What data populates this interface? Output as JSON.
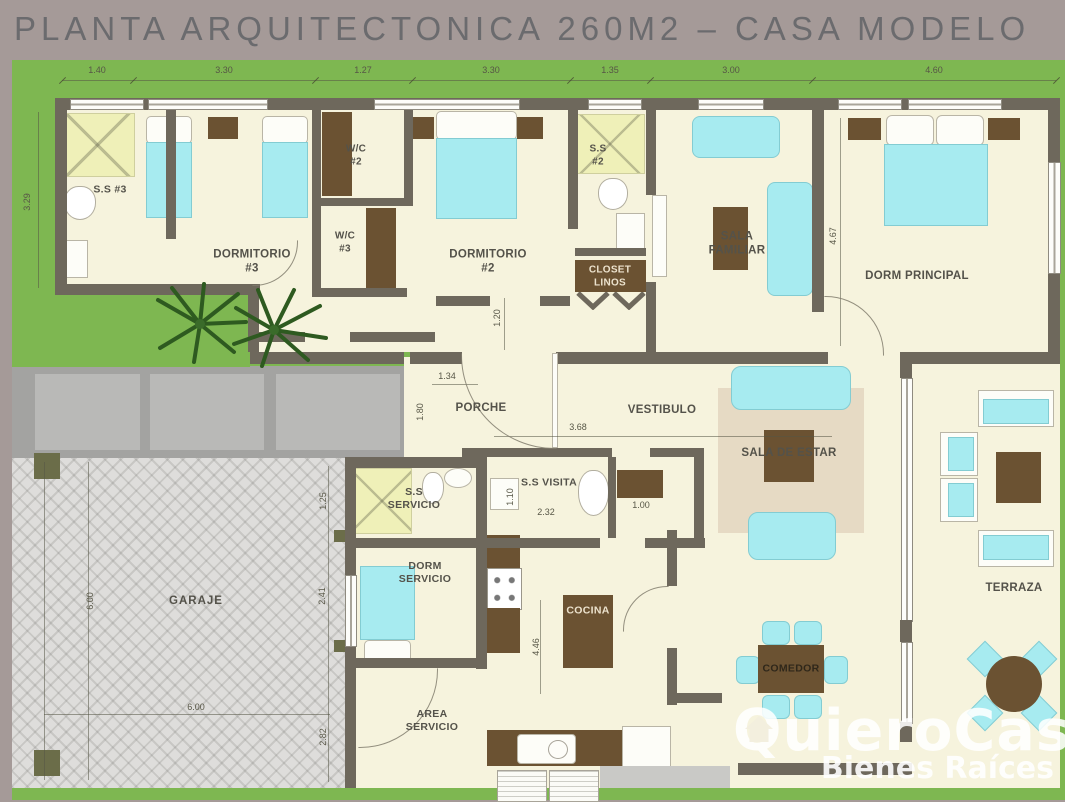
{
  "title": "PLANTA ARQUITECTONICA 260M2 – CASA MODELO",
  "watermark": {
    "brand": "QuieroCasa",
    "tagline": "Bienes Raíces"
  },
  "rooms": {
    "ss3": "S.S #3",
    "dormitorio3": "DORMITORIO #3",
    "wc2": "W/C #2",
    "wc3": "W/C #3",
    "dormitorio2": "DORMITORIO #2",
    "ss2": "S.S #2",
    "closet_linos": "CLOSET LINOS",
    "sala_familiar": "SALA FAMILIAR",
    "dorm_principal": "DORM PRINCIPAL",
    "porche": "PORCHE",
    "vestibulo": "VESTIBULO",
    "sala_de_estar": "SALA DE ESTAR",
    "ss_servicio": "S.S SERVICIO",
    "ss_visita": "S.S VISITA",
    "dorm_servicio": "DORM SERVICIO",
    "cocina": "COCINA",
    "comedor": "COMEDOR",
    "garaje": "GARAJE",
    "area_servicio": "AREA SERVICIO",
    "terraza": "TERRAZA"
  },
  "dims": {
    "top": [
      "1.40",
      "3.30",
      "1.27",
      "3.30",
      "1.35",
      "3.00",
      "4.60"
    ],
    "left_side": "3.29",
    "dorm_principal_depth": "4.67",
    "closet_hall": "1.20",
    "porche_width": "1.34",
    "porche_depth": "1.80",
    "vestibulo_width": "3.68",
    "ss_visita_width": "2.32",
    "ss_visita_depth": "1.10",
    "closet_width": "1.00",
    "cocina_depth": "4.46",
    "garaje_width": "6.00",
    "garaje_depth": "6.00",
    "garaje_right": [
      "1.25",
      "2.41",
      "2.82"
    ]
  },
  "colors": {
    "canvas": "#a59a98",
    "grass": "#7eb751",
    "wall": "#6e685c",
    "floor": "#f6f3dd",
    "furniture_cyan": "#a7ebf0",
    "furniture_brown": "#6b5232",
    "shower": "#eff0b8",
    "driveway": "#a3a3a1",
    "garage_floor": "#dedddb",
    "title_text": "#6b6b6e",
    "watermark_text": "#ffffff"
  }
}
